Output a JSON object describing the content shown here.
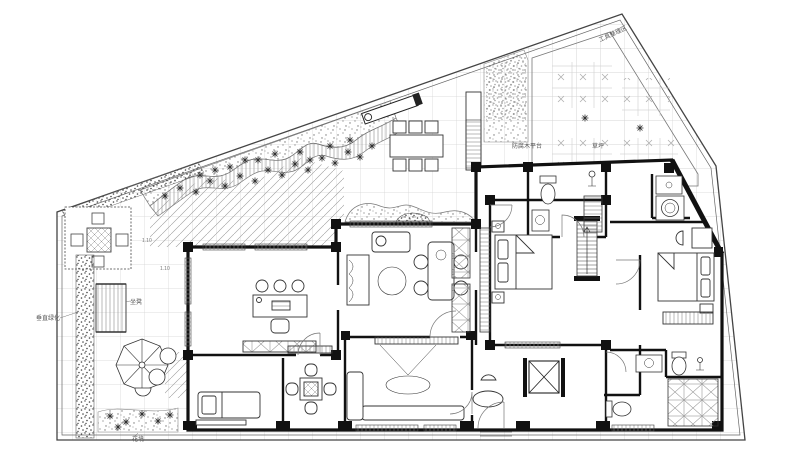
{
  "drawing": {
    "type": "residential floor plan with garden landscape",
    "labels": {
      "tool_area": "工具整理区",
      "deck": "防腐木平台",
      "lawn": "草坪",
      "vertical_green": "垂直绿化",
      "bench": "坐凳",
      "flower_bed": "花境",
      "level_a": "1.10",
      "level_b": "1.10"
    },
    "colors": {
      "background": "#ffffff",
      "wall": "#111111",
      "line": "#2a2a2a",
      "grid": "#d2d2d2",
      "hatch": "#9a9a9a",
      "label_text": "#555555"
    }
  }
}
